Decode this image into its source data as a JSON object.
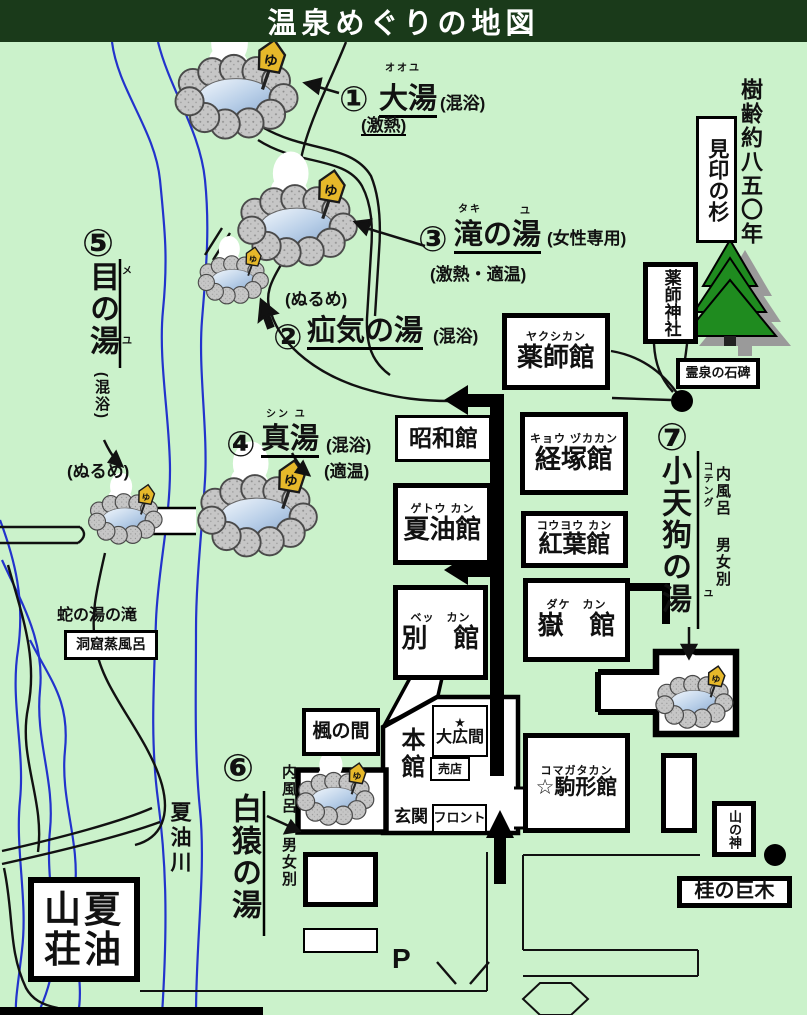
{
  "title": "温泉めぐりの地図",
  "icons": {
    "yu_sign": "ゆ",
    "parking": "P"
  },
  "springs": {
    "s1": {
      "num": "①",
      "furigana": "オオユ",
      "name": "大湯",
      "note": "(混浴)",
      "temp": "(激熱)"
    },
    "s2": {
      "num": "②",
      "name": "疝気の湯",
      "note": "(混浴)",
      "temp": "(ぬるめ)"
    },
    "s3": {
      "num": "③",
      "furigana": "タキ",
      "furigana2": "ユ",
      "name": "滝の湯",
      "note": "(女性専用)",
      "temp": "(激熱・適温)"
    },
    "s4": {
      "num": "④",
      "furigana": "シン  ユ",
      "name": "真湯",
      "note": "(混浴)",
      "temp": "(適温)"
    },
    "s5": {
      "num": "⑤",
      "furigana": "メ",
      "furigana2": "ユ",
      "name": "目の湯",
      "note": "(混浴)",
      "temp": "(ぬるめ)"
    },
    "s6": {
      "num": "⑥",
      "name": "白猿の湯",
      "indoor_bath": "内風呂",
      "gender": "男女別"
    },
    "s7": {
      "num": "⑦",
      "furigana": "コテング",
      "furigana2": "ユ",
      "name": "小天狗の湯",
      "indoor_bath": "内風呂",
      "gender": "男女別"
    }
  },
  "buildings": {
    "yakushikan": {
      "furigana": "ヤクシカン",
      "name": "薬師館"
    },
    "showakan": {
      "name": "昭和館"
    },
    "kyozukakan": {
      "furigana": "キョウ ヅカカン",
      "name": "経塚館"
    },
    "getokan": {
      "furigana": "ゲトウ カン",
      "name": "夏油館"
    },
    "koyokan": {
      "furigana": "コウヨウ カン",
      "name": "紅葉館"
    },
    "bekkan": {
      "furigana": "ベッ　カン",
      "name": "別　館"
    },
    "dakekan": {
      "furigana": "ダケ　カン",
      "name": "嶽　館"
    },
    "komagatakan": {
      "furigana": "コマガタカン",
      "name": "☆駒形館"
    },
    "honkan": {
      "name": "本館"
    },
    "ohiroma": {
      "star": "★",
      "name": "大広間"
    },
    "baiten": {
      "name": "売店"
    },
    "genkan": {
      "name": "玄関"
    },
    "front_desk": {
      "name": "フロント"
    },
    "kaede_room": {
      "name": "楓の間"
    },
    "geto_sanso": {
      "line1": "山夏",
      "line2": "荘油"
    }
  },
  "landmarks": {
    "tree_age": "樹齢約八五〇年",
    "landmark_cedar": "見印の杉",
    "yakushi_shrine": "薬師神社",
    "sacred_stone": "霊泉の石碑",
    "snake_falls": "蛇の湯の滝",
    "cave_steam_bath": "洞窟蒸風呂",
    "geto_river": "夏油川",
    "mountain_god": "山の神",
    "katsura_tree": "桂の巨木"
  },
  "colors": {
    "background": "#cbf2cb",
    "title_bar": "#1a3a1a",
    "river": "#2233cc",
    "sign_yellow": "#e6b82a",
    "tree_green": "#1f8b1f"
  }
}
